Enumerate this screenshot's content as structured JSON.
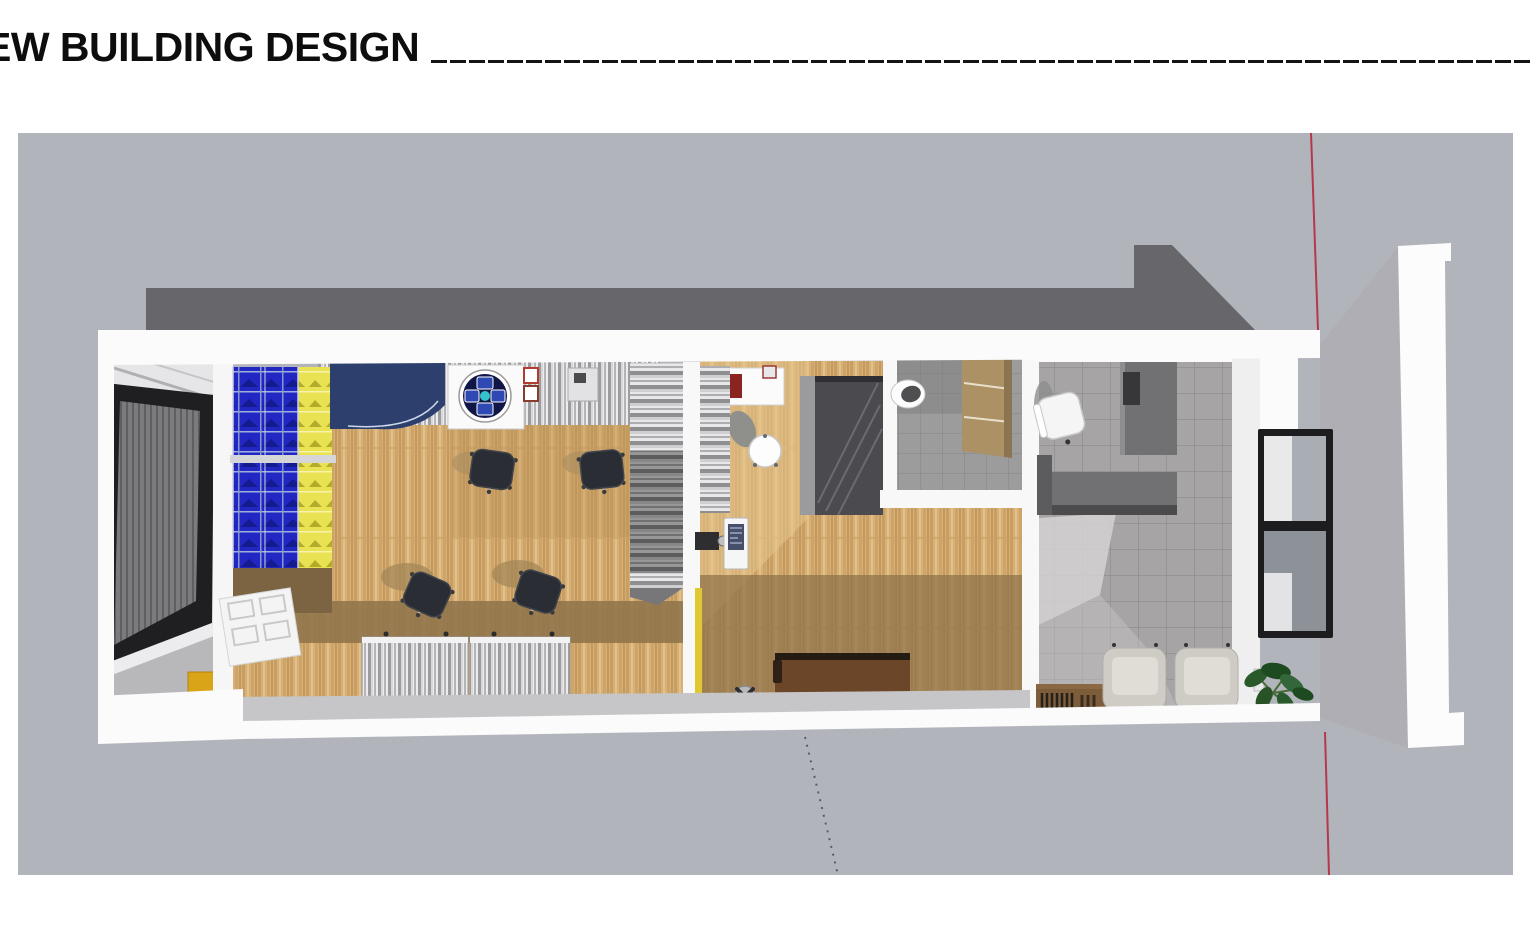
{
  "header": {
    "title": "EW BUILDING DESIGN"
  },
  "palette": {
    "canvas_bg": "#b2b4bb",
    "roof_gray": "#67676b",
    "wall_white": "#fafafa",
    "wood_floor": "#d6b077",
    "wood_dark_band": "#8d7249",
    "rack_blue": "#2227c4",
    "rack_yellow": "#e9e252",
    "machine_navy": "#2d3f6d",
    "stair_metal": "#c9c9cb",
    "tile_gray": "#a6a4a4",
    "counter_dark": "#717173",
    "skylight_purple": "#5d2145",
    "section_line_red": "#b5384a",
    "guide_dot_gray": "#565c6e",
    "rule_black": "#141414"
  },
  "scene": {
    "kind": "3d-floorplan-top-view-render",
    "objects": [
      "roof",
      "garage-door",
      "blue-storage-rack",
      "yellow-storage-rack",
      "navy-machine",
      "dial-machine",
      "office-chairs",
      "metal-cabinets",
      "staircase",
      "round-table",
      "white-desk",
      "wood-sideboard",
      "floor-fan",
      "toilet",
      "wall-shelf",
      "l-shaped-counter",
      "desk-chair",
      "window",
      "lounge-armchairs",
      "potted-plant",
      "book-bench",
      "skylight",
      "section-cut-red-line",
      "dotted-guide-line"
    ]
  }
}
